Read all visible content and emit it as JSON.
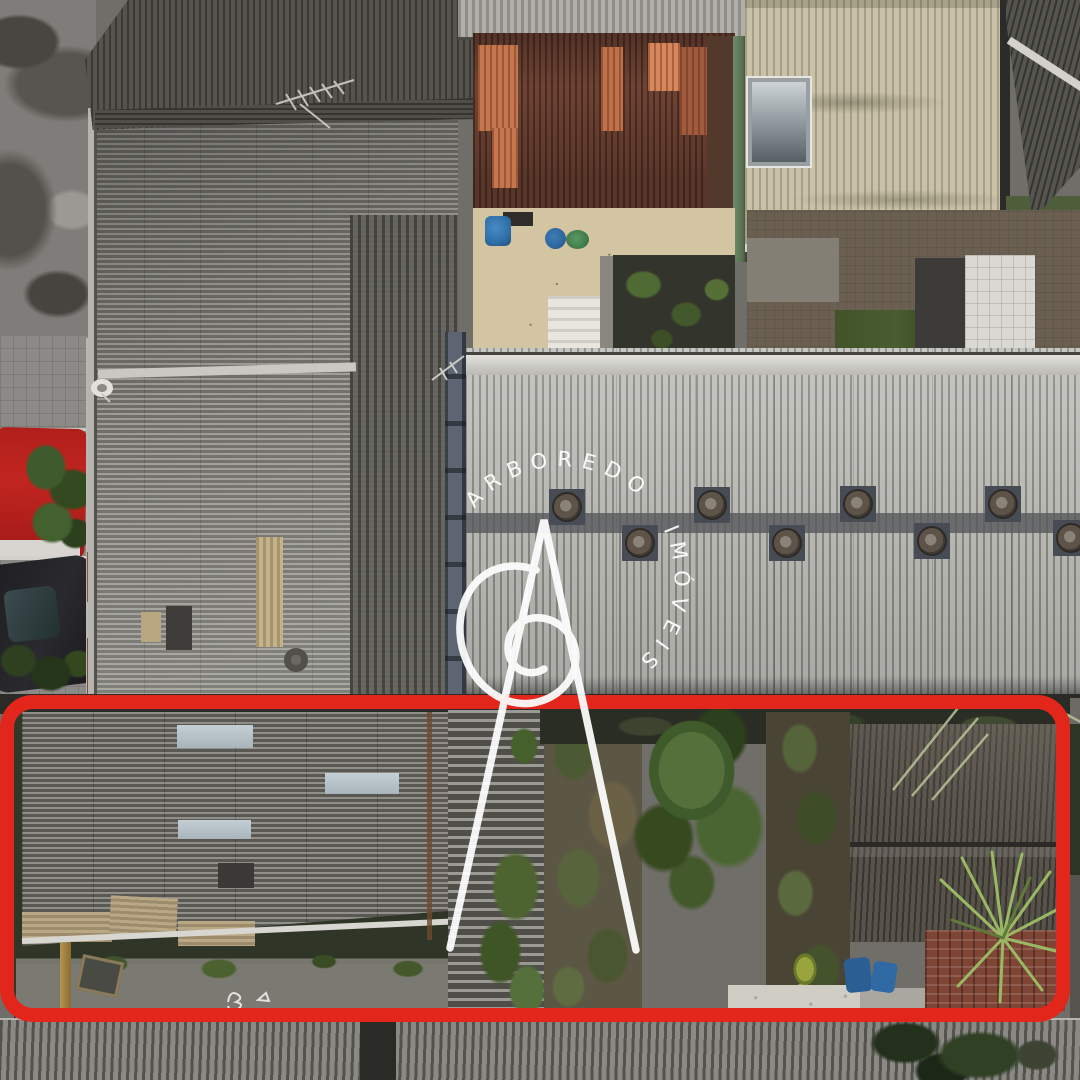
{
  "meta": {
    "media": "aerial-drone-photograph",
    "subject": "Residential block rooftops, top-down view, with one lot outlined for a real-estate listing"
  },
  "watermark": {
    "brand_top": "ARBOREDO",
    "brand_side": "IMÓVEIS",
    "color": "#ffffff",
    "logo": "stylized letter A with spiral flourish"
  },
  "annotation": {
    "shape": "rounded-rectangle",
    "color": "#e3261b",
    "stroke_px": 14,
    "meaning": "highlighted property lot boundary"
  },
  "scene": {
    "top_row": [
      {
        "name": "concrete-street",
        "color": "#7e7d79"
      },
      {
        "name": "dark-corrugated-roof",
        "color": "#46443f",
        "detail": "tv-antenna"
      },
      {
        "name": "terracotta-corrugated-roof",
        "color": "#6f4334",
        "patch_color": "#c4764e"
      },
      {
        "name": "patio-courtyard",
        "color": "#d3c5a2",
        "items": [
          "blue-water-barrels",
          "green-tub",
          "white-stair",
          "garden-beds"
        ]
      },
      {
        "name": "beige-corrugated-roof",
        "color": "#c9c2a9",
        "detail": "skylight"
      },
      {
        "name": "dark-roof-corner",
        "color": "#4a4a45",
        "detail": "white-ridge-beam"
      }
    ],
    "middle_row": [
      {
        "name": "sidewalk-with-cars",
        "items": [
          "red-car",
          "dark-car",
          "satellite-dish"
        ],
        "red_car_color": "#c22520",
        "dark_car_color": "#26262a"
      },
      {
        "name": "left-warehouse-roof",
        "color": "#8a8984",
        "details": [
          "beige-repair-patches",
          "roof-vent"
        ]
      },
      {
        "name": "right-warehouse-roof",
        "color": "#b5b5b1",
        "roof_vent_count": 8,
        "vent_base_color": "#474c54"
      }
    ],
    "highlighted_lot": [
      {
        "name": "gray-fibro-roof-house",
        "color": "#706e68",
        "patch_color": "#b7c2c9"
      },
      {
        "name": "lawn-and-concrete-path",
        "grass_color": "#2f3527",
        "path_color": "#7b7a72",
        "detail": "painted-marks"
      },
      {
        "name": "overgrown-yard",
        "tree_color": "#3f5a2b",
        "ivy_color": "#5c5644"
      },
      {
        "name": "weathered-barn-roof",
        "color": "#57524a"
      },
      {
        "name": "clay-tile-roof",
        "color": "#7e4434"
      },
      {
        "name": "yucca-palm-plant",
        "color": "#9ab864"
      },
      {
        "name": "blue-barrels",
        "color": "#2b5f94"
      }
    ],
    "bottom_row": [
      {
        "name": "foreground-corrugated-roof",
        "color": "#6f6e68"
      }
    ]
  }
}
